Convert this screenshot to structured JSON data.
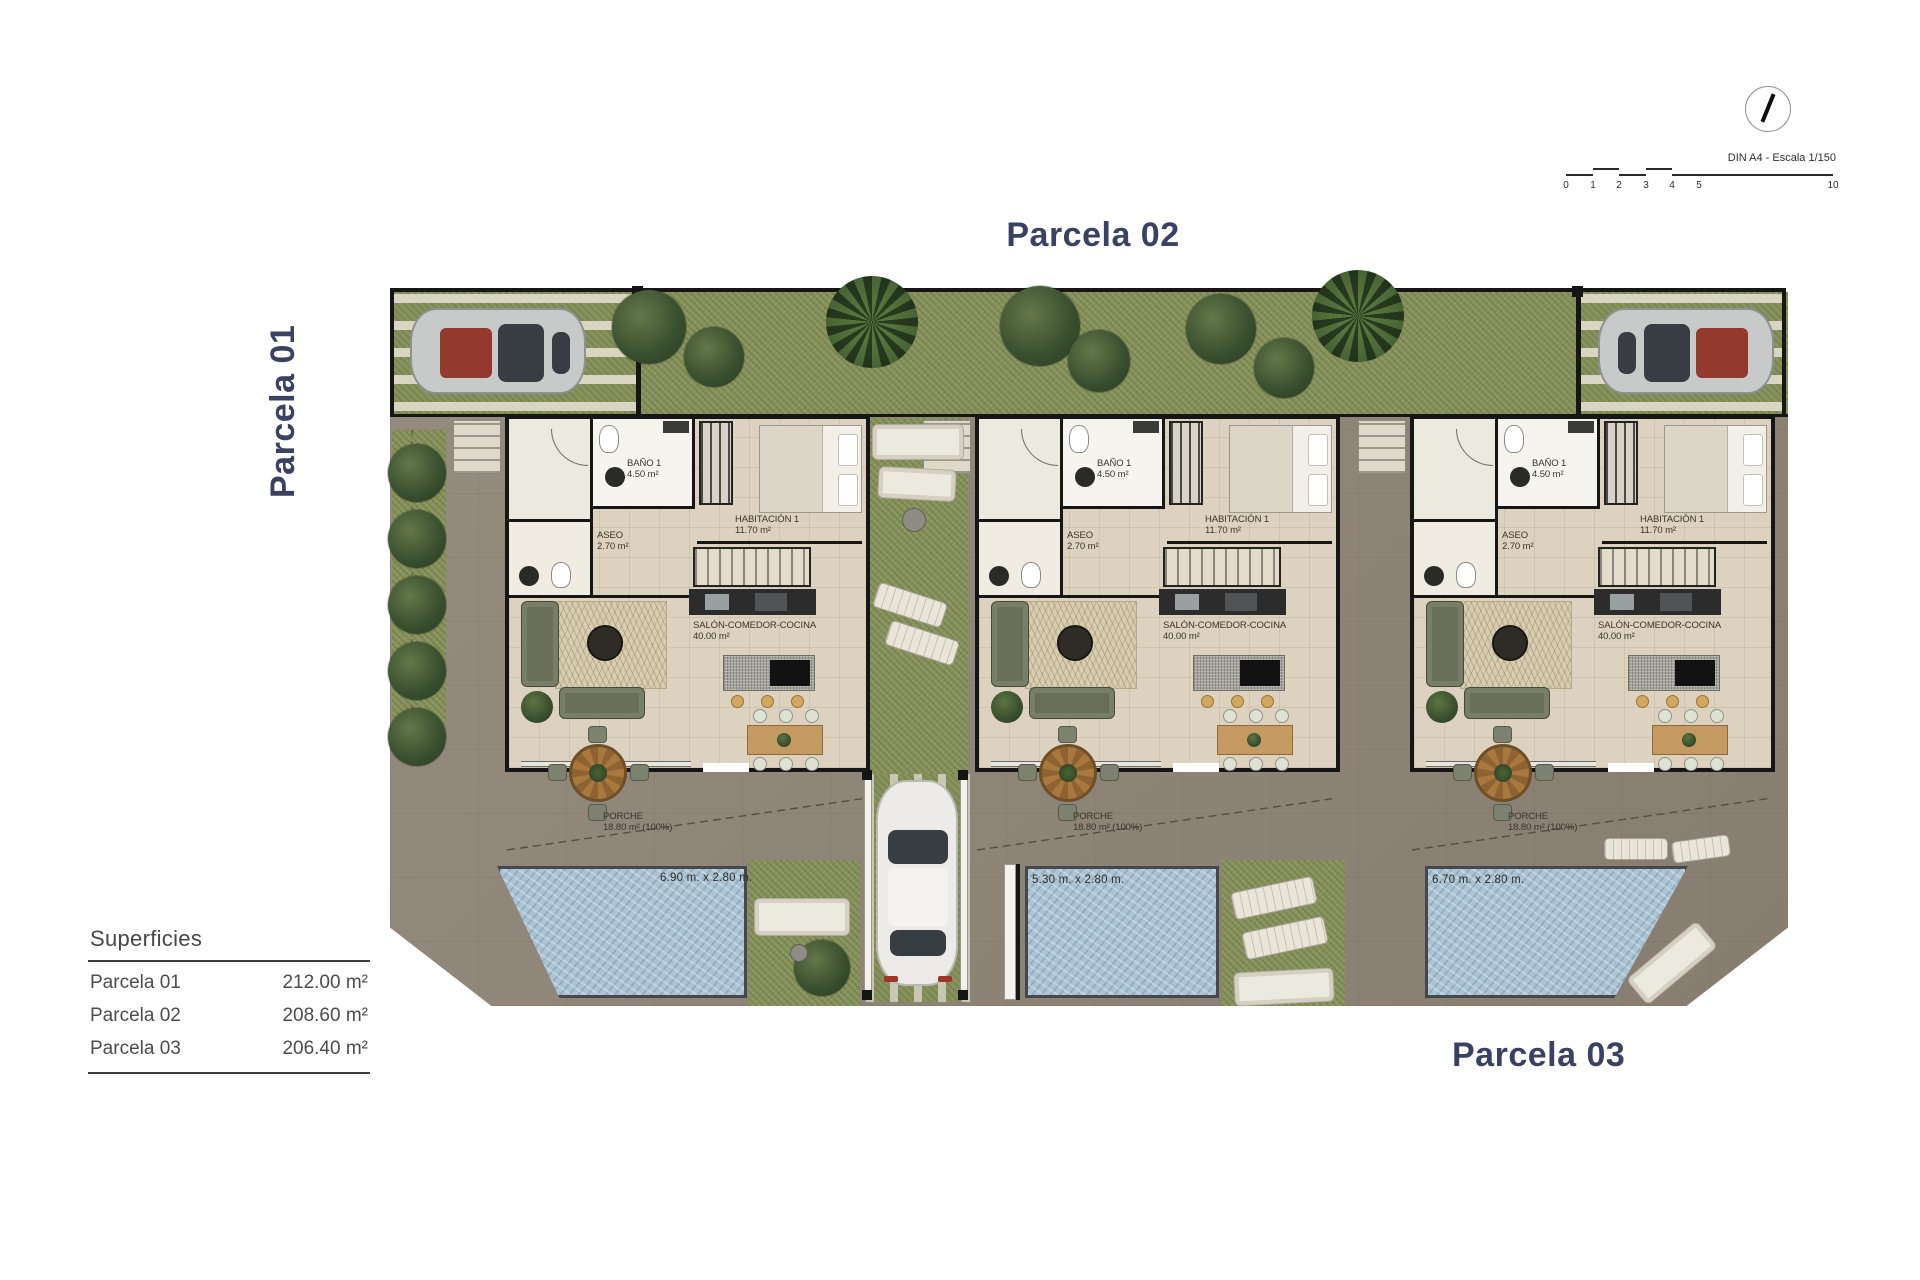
{
  "titles": {
    "parcela_01": "Parcela 01",
    "parcela_02": "Parcela 02",
    "parcela_03": "Parcela 03"
  },
  "legend": {
    "heading": "Superficies",
    "rows": [
      {
        "label": "Parcela 01",
        "value": "212.00 m²"
      },
      {
        "label": "Parcela 02",
        "value": "208.60 m²"
      },
      {
        "label": "Parcela 03",
        "value": "206.40 m²"
      }
    ]
  },
  "scale_bar": {
    "caption": "DIN A4 - Escala 1/150",
    "ticks": [
      "0",
      "1",
      "2",
      "3",
      "4",
      "5"
    ],
    "end_tick": "10"
  },
  "houses": [
    {
      "bano": {
        "name": "BAÑO 1",
        "area": "4.50 m²"
      },
      "aseo": {
        "name": "ASEO",
        "area": "2.70 m²"
      },
      "habitacion": {
        "name": "HABITACIÓN 1",
        "area": "11.70 m²"
      },
      "salon": {
        "name": "SALÓN-COMEDOR-COCINA",
        "area": "40.00 m²"
      },
      "porche": {
        "name": "PORCHE",
        "area": "18.80 m² (100%)"
      }
    },
    {
      "bano": {
        "name": "BAÑO 1",
        "area": "4.50 m²"
      },
      "aseo": {
        "name": "ASEO",
        "area": "2.70 m²"
      },
      "habitacion": {
        "name": "HABITACIÓN 1",
        "area": "11.70 m²"
      },
      "salon": {
        "name": "SALÓN-COMEDOR-COCINA",
        "area": "40.00 m²"
      },
      "porche": {
        "name": "PORCHE",
        "area": "18.80 m² (100%)"
      }
    },
    {
      "bano": {
        "name": "BAÑO 1",
        "area": "4.50 m²"
      },
      "aseo": {
        "name": "ASEO",
        "area": "2.70 m²"
      },
      "habitacion": {
        "name": "HABITACIÓN 1",
        "area": "11.70 m²"
      },
      "salon": {
        "name": "SALÓN-COMEDOR-COCINA",
        "area": "40.00 m²"
      },
      "porche": {
        "name": "PORCHE",
        "area": "18.80 m² (100%)"
      }
    }
  ],
  "pools": [
    {
      "dimensions": "6.90 m. x 2.80 m."
    },
    {
      "dimensions": "5.30 m. x 2.80 m."
    },
    {
      "dimensions": "6.70 m. x 2.80 m."
    }
  ],
  "colors": {
    "title_navy": "#3a4162",
    "grass_green": "#87925c",
    "terrace_taupe": "#8f8577",
    "pool_blue": "#abc3d2",
    "house_floor_beige": "#dcd2bf",
    "wall_black": "#161616"
  }
}
